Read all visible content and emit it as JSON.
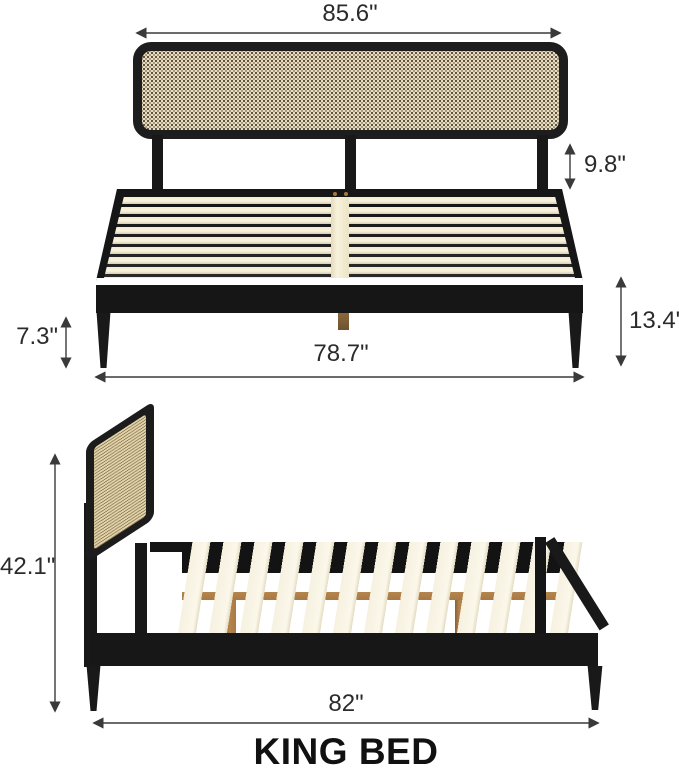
{
  "page": {
    "title": "KING BED"
  },
  "front_view": {
    "dimensions": {
      "headboard_width": "85.6\"",
      "headboard_clearance": "9.8\"",
      "leg_height": "7.3\"",
      "platform_height": "13.4\"",
      "frame_width": "78.7\""
    }
  },
  "side_view": {
    "dimensions": {
      "overall_height": "42.1\"",
      "frame_length": "82\""
    }
  },
  "colors": {
    "frame_black": "#1a1a1a",
    "rattan_base": "#e7ddc2",
    "rattan_dot": "#40311c",
    "slat_cream": "#f3ecd3",
    "wood_tan": "#b5854e",
    "brass": "#8a683c",
    "dimension_line": "#3a3a3a",
    "label_text": "#2b2b2b"
  }
}
